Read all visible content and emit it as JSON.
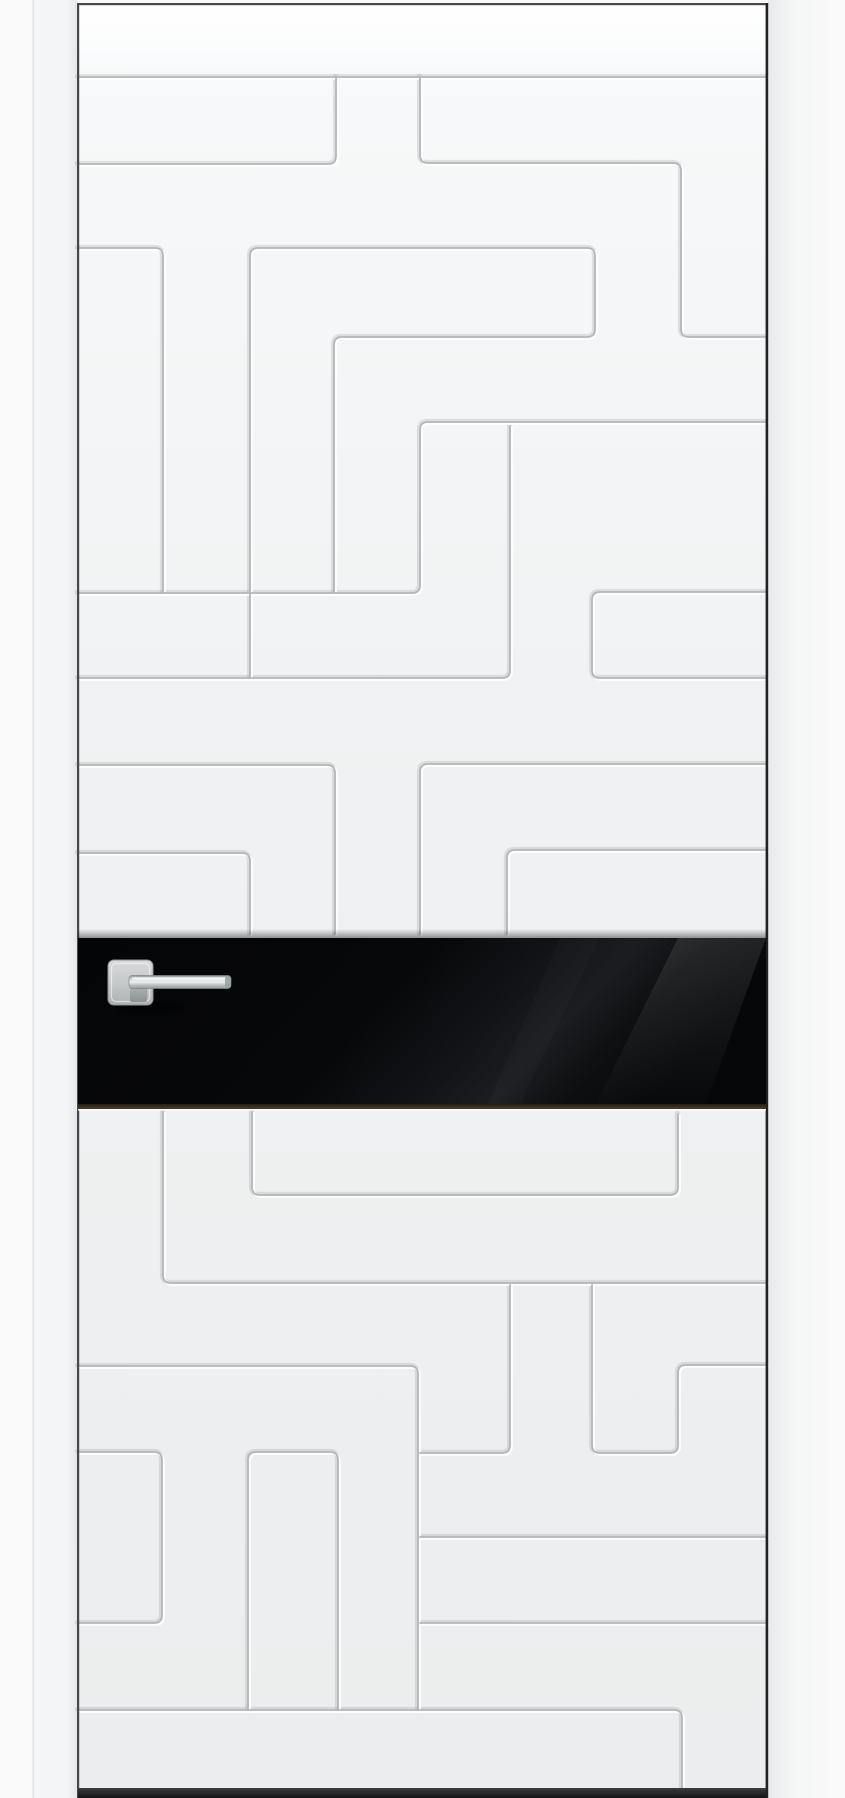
{
  "scene": {
    "description": "White interior door leaf with milled maze pattern, horizontal black glass insert and chrome square-rose lever handle, shown on a white wall",
    "view": "front product photo",
    "visible_text": ""
  },
  "door": {
    "leaf": {
      "x": 78,
      "y": 3,
      "width": 688,
      "height": 1790
    },
    "glass_insert": {
      "x": 78,
      "y": 938,
      "width": 688,
      "height": 168
    },
    "handle": {
      "rose": {
        "x": 108,
        "y": 960,
        "size": 45,
        "corner_radius": 6
      },
      "lever": {
        "x": 129,
        "y": 975,
        "length": 102,
        "height": 13
      }
    }
  },
  "colors": {
    "wall": "#fafafa",
    "wallStrip": "#f4f5f6",
    "frameLine": "#e2e3e4",
    "leafTop": "#fbfcfd",
    "leafBottom": "#ebedee",
    "groove": "#b3b6b8",
    "grooveLight": "#ffffff",
    "edge": "#46494b",
    "edgeDark": "#202224",
    "glass": "#08090a",
    "glassBottomEdge": "#3a2f22",
    "chrome": "#c9cccd",
    "chromeDark": "#8f9496",
    "bottomShadow": "#1a1b1c"
  }
}
